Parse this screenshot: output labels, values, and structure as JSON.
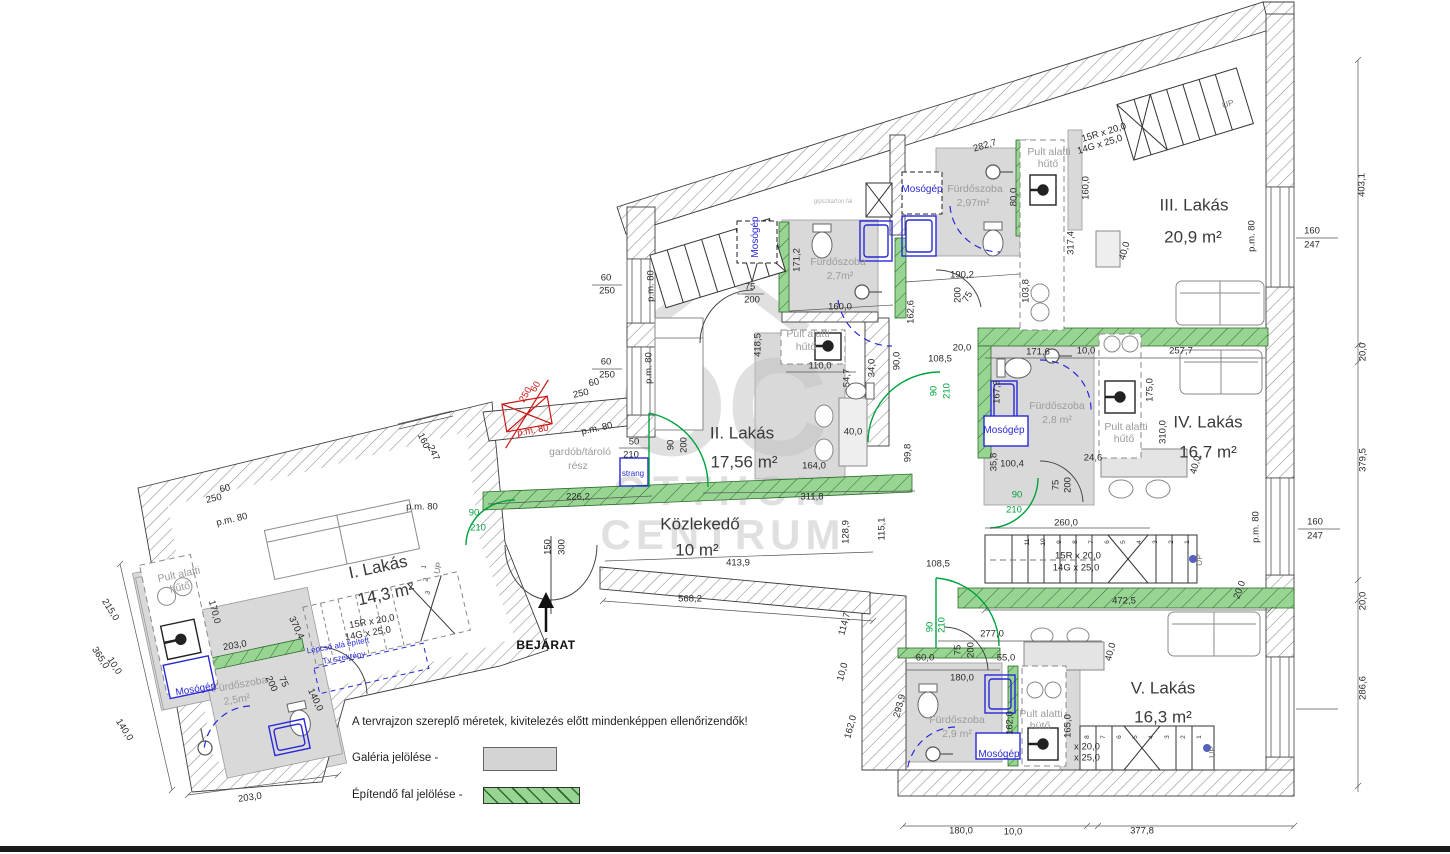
{
  "title": "Emeleti alaprajz",
  "watermark": {
    "logo": "OC",
    "brand_top": "OTTHON",
    "brand_bottom": "CENTRUM"
  },
  "legend": {
    "note": "A tervrajzon szereplő méretek, kivitelezés előtt mindenképpen ellenőrizendők!",
    "galeria": "Galéria jelölése -",
    "epitendo": "Építendő fal jelölése -"
  },
  "units": [
    {
      "name": "I. Lakás",
      "area": "14,3 m²",
      "bathroom": "Fürdőszoba 2,5m²"
    },
    {
      "name": "II. Lakás",
      "area": "17,56 m²",
      "bathroom": "Fürdőszoba 2,7m²"
    },
    {
      "name": "III. Lakás",
      "area": "20,9 m²",
      "bathroom": "Fürdőszoba 2,97m²"
    },
    {
      "name": "IV. Lakás",
      "area": "16,7 m²",
      "bathroom": "Fürdőszoba 2,8 m²"
    },
    {
      "name": "V. Lakás",
      "area": "16,3 m²",
      "bathroom": "Fürdőszoba 2,9 m²"
    }
  ],
  "corridor": {
    "name": "Közlekedő",
    "area": "10 m²"
  },
  "entrance_label": "BEJÁRAT",
  "colors": {
    "new_wall_green": "#98d593",
    "door_green": "#00a33e",
    "fixture_blue": "#2929d8",
    "demolish_red": "#cc1414",
    "gallery_gray": "#d4d4d4",
    "watermark_gray": "#c3c3c3"
  },
  "ann": [
    {
      "t": "I. Lakás",
      "x": 378,
      "y": 567,
      "r": -12,
      "c": "apt"
    },
    {
      "t": "14,3 m²",
      "x": 386,
      "y": 594,
      "r": -12,
      "c": "apt"
    },
    {
      "t": "II. Lakás",
      "x": 742,
      "y": 433,
      "c": "apt"
    },
    {
      "t": "17,56 m²",
      "x": 744,
      "y": 462,
      "c": "apt"
    },
    {
      "t": "III. Lakás",
      "x": 1194,
      "y": 205,
      "c": "apt"
    },
    {
      "t": "20,9 m²",
      "x": 1193,
      "y": 237,
      "c": "apt"
    },
    {
      "t": "IV. Lakás",
      "x": 1208,
      "y": 422,
      "c": "apt"
    },
    {
      "t": "16,7 m²",
      "x": 1208,
      "y": 452,
      "c": "apt"
    },
    {
      "t": "V. Lakás",
      "x": 1163,
      "y": 688,
      "c": "apt"
    },
    {
      "t": "16,3 m²",
      "x": 1163,
      "y": 717,
      "c": "apt"
    },
    {
      "t": "Közlekedő",
      "x": 700,
      "y": 524,
      "c": "apt"
    },
    {
      "t": "10 m²",
      "x": 697,
      "y": 550,
      "c": "apt"
    },
    {
      "t": "BEJÁRAT",
      "x": 546,
      "y": 645,
      "c": "bej"
    },
    {
      "t": "Fürdőszoba",
      "x": 838,
      "y": 262,
      "c": "room"
    },
    {
      "t": "2,7m²",
      "x": 840,
      "y": 276,
      "c": "room"
    },
    {
      "t": "Fürdőszoba",
      "x": 975,
      "y": 189,
      "c": "room"
    },
    {
      "t": "2,97m²",
      "x": 973,
      "y": 203,
      "c": "room"
    },
    {
      "t": "Fürdőszoba",
      "x": 1057,
      "y": 406,
      "c": "room"
    },
    {
      "t": "2,8 m²",
      "x": 1057,
      "y": 420,
      "c": "room"
    },
    {
      "t": "Fürdőszoba",
      "x": 957,
      "y": 720,
      "c": "room"
    },
    {
      "t": "2,9 m²",
      "x": 957,
      "y": 734,
      "c": "room"
    },
    {
      "t": "Fürdőszoba",
      "x": 240,
      "y": 685,
      "r": -10,
      "c": "room"
    },
    {
      "t": "2,5m²",
      "x": 237,
      "y": 700,
      "r": -10,
      "c": "room"
    },
    {
      "t": "Pult alatti",
      "x": 808,
      "y": 334,
      "c": "room"
    },
    {
      "t": "hűtő",
      "x": 806,
      "y": 347,
      "c": "room"
    },
    {
      "t": "Pult alatti",
      "x": 1049,
      "y": 152,
      "c": "room"
    },
    {
      "t": "hűtő",
      "x": 1048,
      "y": 164,
      "c": "room"
    },
    {
      "t": "Pult alatti",
      "x": 1126,
      "y": 427,
      "c": "room"
    },
    {
      "t": "hűtő",
      "x": 1124,
      "y": 439,
      "c": "room"
    },
    {
      "t": "Pult alatti",
      "x": 1041,
      "y": 714,
      "c": "room"
    },
    {
      "t": "hütő",
      "x": 1040,
      "y": 726,
      "c": "room"
    },
    {
      "t": "Pult alatti",
      "x": 179,
      "y": 575,
      "r": -12,
      "c": "room"
    },
    {
      "t": "hűtő",
      "x": 180,
      "y": 588,
      "r": -12,
      "c": "room"
    },
    {
      "t": "gardób/tároló",
      "x": 580,
      "y": 452,
      "c": "room"
    },
    {
      "t": "rész",
      "x": 578,
      "y": 466,
      "c": "room"
    },
    {
      "t": "gipszkarton fal",
      "x": 833,
      "y": 202,
      "c": "tiny"
    },
    {
      "t": "Mosógép",
      "x": 922,
      "y": 190,
      "c": "b"
    },
    {
      "t": "Mosógép",
      "x": 756,
      "y": 237,
      "r": -90,
      "c": "b"
    },
    {
      "t": "Mosógép",
      "x": 1004,
      "y": 431,
      "c": "b"
    },
    {
      "t": "Mosógép",
      "x": 999,
      "y": 755,
      "c": "b"
    },
    {
      "t": "Mosógép",
      "x": 196,
      "y": 690,
      "r": -10,
      "c": "b"
    },
    {
      "t": "strang",
      "x": 633,
      "y": 474,
      "c": "b2"
    },
    {
      "t": "Lépcső alá épített",
      "x": 338,
      "y": 646,
      "r": -10,
      "c": "b2"
    },
    {
      "t": "Tv szekrény",
      "x": 344,
      "y": 658,
      "r": -10,
      "c": "b2"
    },
    {
      "t": "15R x 20,0",
      "x": 1104,
      "y": 133,
      "r": -17
    },
    {
      "t": "14G x 25,0",
      "x": 1100,
      "y": 145,
      "r": -17
    },
    {
      "t": "15R x 20,0",
      "x": 1078,
      "y": 556
    },
    {
      "t": "14G x 25,0",
      "x": 1076,
      "y": 568
    },
    {
      "t": "15R x 20,0",
      "x": 372,
      "y": 622,
      "r": -10
    },
    {
      "t": "14G x 25,0",
      "x": 368,
      "y": 634,
      "r": -10
    },
    {
      "t": "x 20,0",
      "x": 1087,
      "y": 747
    },
    {
      "t": "x 25,0",
      "x": 1087,
      "y": 758
    },
    {
      "t": "UP",
      "x": 1228,
      "y": 104,
      "r": -17,
      "c": "up"
    },
    {
      "t": "UP",
      "x": 1199,
      "y": 560,
      "r": -90,
      "c": "up"
    },
    {
      "t": "UP",
      "x": 1212,
      "y": 752,
      "r": -90,
      "c": "up"
    },
    {
      "t": "UP",
      "x": 438,
      "y": 568,
      "r": -75,
      "c": "up"
    },
    {
      "t": "1",
      "x": 1188,
      "y": 542,
      "r": -90,
      "c": "tn"
    },
    {
      "t": "2",
      "x": 1172,
      "y": 542,
      "r": -90,
      "c": "tn"
    },
    {
      "t": "3",
      "x": 1156,
      "y": 542,
      "r": -90,
      "c": "tn"
    },
    {
      "t": "4",
      "x": 1140,
      "y": 542,
      "r": -90,
      "c": "tn"
    },
    {
      "t": "5",
      "x": 1124,
      "y": 542,
      "r": -90,
      "c": "tn"
    },
    {
      "t": "6",
      "x": 1108,
      "y": 542,
      "r": -90,
      "c": "tn"
    },
    {
      "t": "7",
      "x": 1092,
      "y": 542,
      "r": -90,
      "c": "tn"
    },
    {
      "t": "8",
      "x": 1076,
      "y": 542,
      "r": -90,
      "c": "tn"
    },
    {
      "t": "9",
      "x": 1060,
      "y": 542,
      "r": -90,
      "c": "tn"
    },
    {
      "t": "10",
      "x": 1044,
      "y": 542,
      "r": -90,
      "c": "tn"
    },
    {
      "t": "11",
      "x": 1028,
      "y": 542,
      "r": -90,
      "c": "tn"
    },
    {
      "t": "1",
      "x": 1200,
      "y": 737,
      "r": -90,
      "c": "tn"
    },
    {
      "t": "2",
      "x": 1184,
      "y": 737,
      "r": -90,
      "c": "tn"
    },
    {
      "t": "3",
      "x": 1168,
      "y": 737,
      "r": -90,
      "c": "tn"
    },
    {
      "t": "4",
      "x": 1152,
      "y": 737,
      "r": -90,
      "c": "tn"
    },
    {
      "t": "5",
      "x": 1136,
      "y": 737,
      "r": -90,
      "c": "tn"
    },
    {
      "t": "6",
      "x": 1120,
      "y": 737,
      "r": -90,
      "c": "tn"
    },
    {
      "t": "7",
      "x": 1104,
      "y": 737,
      "r": -90,
      "c": "tn"
    },
    {
      "t": "8",
      "x": 1088,
      "y": 737,
      "r": -90,
      "c": "tn"
    },
    {
      "t": "1",
      "x": 425,
      "y": 567,
      "r": -75,
      "c": "tn"
    },
    {
      "t": "2",
      "x": 427,
      "y": 580,
      "r": -75,
      "c": "tn"
    },
    {
      "t": "3",
      "x": 429,
      "y": 593,
      "r": -75,
      "c": "tn"
    },
    {
      "t": "60",
      "x": 606,
      "y": 278
    },
    {
      "t": "250",
      "x": 607,
      "y": 291
    },
    {
      "t": "60",
      "x": 606,
      "y": 362
    },
    {
      "t": "250",
      "x": 607,
      "y": 375
    },
    {
      "t": "p.m. 80",
      "x": 651,
      "y": 286,
      "r": -90
    },
    {
      "t": "p.m. 80",
      "x": 649,
      "y": 368,
      "r": -90
    },
    {
      "t": "60",
      "x": 594,
      "y": 383,
      "r": -12
    },
    {
      "t": "250",
      "x": 581,
      "y": 394,
      "r": -12
    },
    {
      "t": "p.m. 80",
      "x": 597,
      "y": 429,
      "r": -12
    },
    {
      "t": "50",
      "x": 634,
      "y": 442
    },
    {
      "t": "210",
      "x": 631,
      "y": 455
    },
    {
      "t": "226,2",
      "x": 578,
      "y": 497
    },
    {
      "t": "90",
      "x": 474,
      "y": 513,
      "c": "g"
    },
    {
      "t": "210",
      "x": 478,
      "y": 528,
      "c": "g"
    },
    {
      "t": "150",
      "x": 548,
      "y": 547,
      "r": -90
    },
    {
      "t": "300",
      "x": 562,
      "y": 547,
      "r": -90
    },
    {
      "t": "568,2",
      "x": 690,
      "y": 599
    },
    {
      "t": "413,9",
      "x": 738,
      "y": 563
    },
    {
      "t": "311,8",
      "x": 812,
      "y": 497
    },
    {
      "t": "128,9",
      "x": 846,
      "y": 532,
      "r": -90
    },
    {
      "t": "115,1",
      "x": 882,
      "y": 529,
      "r": -90
    },
    {
      "t": "164,0",
      "x": 814,
      "y": 466
    },
    {
      "t": "40,0",
      "x": 853,
      "y": 432
    },
    {
      "t": "99,8",
      "x": 908,
      "y": 453,
      "r": -90
    },
    {
      "t": "90",
      "x": 671,
      "y": 445,
      "r": -90
    },
    {
      "t": "200",
      "x": 684,
      "y": 445,
      "r": -90
    },
    {
      "t": "418,5",
      "x": 758,
      "y": 345,
      "r": -90
    },
    {
      "t": "110,0",
      "x": 820,
      "y": 366
    },
    {
      "t": "54,7",
      "x": 847,
      "y": 378,
      "r": -90
    },
    {
      "t": "34,0",
      "x": 872,
      "y": 368,
      "r": -90
    },
    {
      "t": "90,0",
      "x": 897,
      "y": 361,
      "r": -90
    },
    {
      "t": "162,6",
      "x": 911,
      "y": 312,
      "r": -90
    },
    {
      "t": "20,0",
      "x": 962,
      "y": 348
    },
    {
      "t": "108,5",
      "x": 940,
      "y": 359
    },
    {
      "t": "90",
      "x": 934,
      "y": 391,
      "r": -90,
      "c": "g"
    },
    {
      "t": "210",
      "x": 947,
      "y": 391,
      "r": -90,
      "c": "g"
    },
    {
      "t": "190,2",
      "x": 962,
      "y": 275
    },
    {
      "t": "200",
      "x": 958,
      "y": 295,
      "r": -90
    },
    {
      "t": "75",
      "x": 968,
      "y": 297,
      "r": -60
    },
    {
      "t": "103,8",
      "x": 1026,
      "y": 291,
      "r": -90
    },
    {
      "t": "282,7",
      "x": 985,
      "y": 146,
      "r": -17
    },
    {
      "t": "171,2",
      "x": 797,
      "y": 260,
      "r": -90
    },
    {
      "t": "75",
      "x": 750,
      "y": 287
    },
    {
      "t": "200",
      "x": 752,
      "y": 300
    },
    {
      "t": "160,0",
      "x": 840,
      "y": 307
    },
    {
      "t": "80,0",
      "x": 1014,
      "y": 197,
      "r": -90
    },
    {
      "t": "160,0",
      "x": 1086,
      "y": 188,
      "r": -90
    },
    {
      "t": "317,4",
      "x": 1071,
      "y": 243,
      "r": -90
    },
    {
      "t": "40,0",
      "x": 1125,
      "y": 251,
      "r": -75
    },
    {
      "t": "p.m. 80",
      "x": 1252,
      "y": 236,
      "r": -90
    },
    {
      "t": "160",
      "x": 1312,
      "y": 231
    },
    {
      "t": "247",
      "x": 1312,
      "y": 245
    },
    {
      "t": "403,1",
      "x": 1362,
      "y": 185,
      "r": -90
    },
    {
      "t": "20,0",
      "x": 1363,
      "y": 352,
      "r": -90
    },
    {
      "t": "379,5",
      "x": 1363,
      "y": 460,
      "r": -90
    },
    {
      "t": "20,0",
      "x": 1363,
      "y": 601,
      "r": -90
    },
    {
      "t": "286,6",
      "x": 1363,
      "y": 688,
      "r": -90
    },
    {
      "t": "171,6",
      "x": 1038,
      "y": 352
    },
    {
      "t": "10,0",
      "x": 1086,
      "y": 351
    },
    {
      "t": "257,7",
      "x": 1181,
      "y": 351
    },
    {
      "t": "167,3",
      "x": 997,
      "y": 392,
      "r": -90
    },
    {
      "t": "175,0",
      "x": 1150,
      "y": 390,
      "r": -90
    },
    {
      "t": "310,0",
      "x": 1163,
      "y": 432,
      "r": -90
    },
    {
      "t": "40,0",
      "x": 1196,
      "y": 465,
      "r": -75
    },
    {
      "t": "35,8",
      "x": 994,
      "y": 462,
      "r": -90
    },
    {
      "t": "100,4",
      "x": 1012,
      "y": 464
    },
    {
      "t": "24,6",
      "x": 1093,
      "y": 458
    },
    {
      "t": "75",
      "x": 1056,
      "y": 485,
      "r": -90
    },
    {
      "t": "200",
      "x": 1068,
      "y": 485,
      "r": -90
    },
    {
      "t": "90",
      "x": 1017,
      "y": 495,
      "c": "g"
    },
    {
      "t": "210",
      "x": 1014,
      "y": 510,
      "c": "g"
    },
    {
      "t": "260,0",
      "x": 1066,
      "y": 523
    },
    {
      "t": "160",
      "x": 1315,
      "y": 522
    },
    {
      "t": "247",
      "x": 1315,
      "y": 536
    },
    {
      "t": "p.m. 80",
      "x": 1256,
      "y": 527,
      "r": -90
    },
    {
      "t": "472,5",
      "x": 1124,
      "y": 601
    },
    {
      "t": "20,0",
      "x": 1240,
      "y": 590,
      "r": -70
    },
    {
      "t": "277,0",
      "x": 992,
      "y": 634
    },
    {
      "t": "60,0",
      "x": 925,
      "y": 658
    },
    {
      "t": "75",
      "x": 958,
      "y": 650,
      "r": -90
    },
    {
      "t": "200",
      "x": 971,
      "y": 650,
      "r": -90
    },
    {
      "t": "55,0",
      "x": 1006,
      "y": 658
    },
    {
      "t": "40,0",
      "x": 1111,
      "y": 652,
      "r": -75
    },
    {
      "t": "180,0",
      "x": 962,
      "y": 678
    },
    {
      "t": "162,0",
      "x": 1010,
      "y": 723,
      "r": -90
    },
    {
      "t": "165,0",
      "x": 1068,
      "y": 726,
      "r": -90
    },
    {
      "t": "293,9",
      "x": 900,
      "y": 706,
      "r": -75
    },
    {
      "t": "114,7",
      "x": 845,
      "y": 624,
      "r": -75
    },
    {
      "t": "10,0",
      "x": 843,
      "y": 672,
      "r": -75
    },
    {
      "t": "162,0",
      "x": 851,
      "y": 727,
      "r": -75
    },
    {
      "t": "108,5",
      "x": 938,
      "y": 564
    },
    {
      "t": "90",
      "x": 930,
      "y": 627,
      "r": -90,
      "c": "g"
    },
    {
      "t": "210",
      "x": 942,
      "y": 625,
      "r": -90,
      "c": "g"
    },
    {
      "t": "180,0",
      "x": 961,
      "y": 831
    },
    {
      "t": "10,0",
      "x": 1013,
      "y": 832
    },
    {
      "t": "377,8",
      "x": 1142,
      "y": 831
    },
    {
      "t": "215,0",
      "x": 110,
      "y": 610,
      "r": 58
    },
    {
      "t": "365,0",
      "x": 100,
      "y": 658,
      "r": 58
    },
    {
      "t": "10,0",
      "x": 114,
      "y": 666,
      "r": 58
    },
    {
      "t": "140,0",
      "x": 124,
      "y": 730,
      "r": 58
    },
    {
      "t": "203,0",
      "x": 250,
      "y": 798,
      "r": -8
    },
    {
      "t": "203,0",
      "x": 235,
      "y": 646,
      "r": -10
    },
    {
      "t": "170,0",
      "x": 214,
      "y": 612,
      "r": 75
    },
    {
      "t": "370,4",
      "x": 296,
      "y": 628,
      "r": 65
    },
    {
      "t": "75",
      "x": 283,
      "y": 682,
      "r": 65
    },
    {
      "t": "200",
      "x": 271,
      "y": 684,
      "r": 65
    },
    {
      "t": "140,0",
      "x": 315,
      "y": 700,
      "r": 65
    },
    {
      "t": "160",
      "x": 423,
      "y": 441,
      "r": 65
    },
    {
      "t": "247",
      "x": 433,
      "y": 453,
      "r": 65
    },
    {
      "t": "60",
      "x": 225,
      "y": 489,
      "r": -13
    },
    {
      "t": "250",
      "x": 214,
      "y": 499,
      "r": -13
    },
    {
      "t": "p.m. 80",
      "x": 232,
      "y": 520,
      "r": -13
    },
    {
      "t": "p.m. 80",
      "x": 422,
      "y": 507
    },
    {
      "t": "60",
      "x": 536,
      "y": 387,
      "r": -60,
      "c": "r"
    },
    {
      "t": "250",
      "x": 526,
      "y": 395,
      "r": -60,
      "c": "r"
    },
    {
      "t": "p.m. 80",
      "x": 533,
      "y": 431,
      "r": -10,
      "c": "r"
    }
  ]
}
